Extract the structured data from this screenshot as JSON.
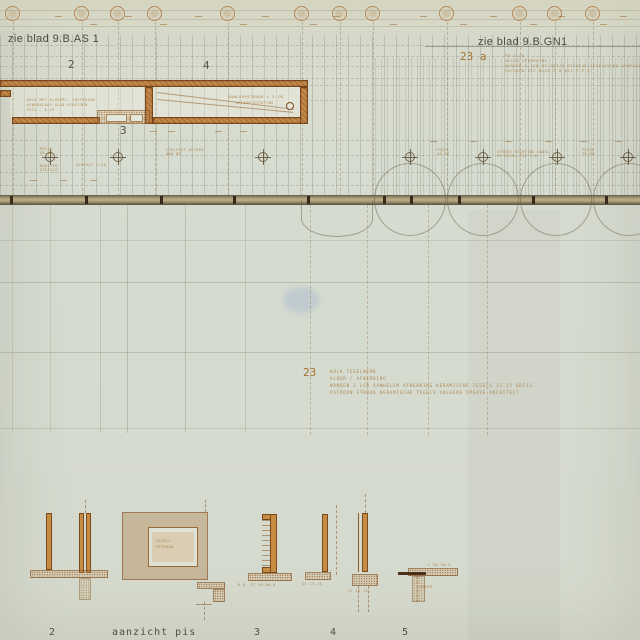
{
  "sheet": {
    "match_left": "zie blad 9.B.AS 1",
    "match_right": "zie blad 9.B.GN1"
  },
  "plan": {
    "grid_label_2": "2",
    "grid_label_4": "4",
    "detail_label_3": "3"
  },
  "notes": {
    "a": {
      "num": "23 a",
      "lines": [
        "PB GLAD",
        "KOLOM AFWERKING",
        "WANDEN  2 LGN KZ GRIJS  GEVOEGD OPGELEVERD  AFWERKING NADER",
        "PATROON  ZIE BLAD 9.B  N13  T.P.V."
      ]
    },
    "b": {
      "num": "23",
      "lines": [
        "KOLK TEGELWERK",
        "VLOER / AFWERKING",
        "WANDEN  2 LGN  AANHELEN  AFWERKING KERAMISCHE  TEGELS  15.15  GRIJS",
        "PATROON  STROOK KERAMISCHE TEGELS  VOLGENS  OPGAVE  ARCHITECT"
      ]
    }
  },
  "bottom_labels": [
    {
      "t": "2",
      "x": 49
    },
    {
      "t": "aanzicht pis",
      "x": 112
    },
    {
      "t": "3",
      "x": 254
    },
    {
      "t": "4",
      "x": 330
    },
    {
      "t": "5",
      "x": 402
    }
  ],
  "drawing": {
    "bubble_xs": [
      13,
      82,
      118,
      155,
      228,
      302,
      340,
      373,
      447,
      520,
      555,
      593
    ],
    "band_tick_xs": [
      10,
      85,
      160,
      233,
      307,
      383,
      410,
      458,
      532,
      605
    ],
    "cross_xs": [
      50,
      118,
      263,
      410,
      483,
      557,
      628
    ],
    "circle_xs": [
      410,
      483,
      556,
      629
    ],
    "half_circle_x": 337,
    "mid_vert": [
      {
        "x": 12,
        "o": 0.2
      },
      {
        "x": 50,
        "o": 0.2
      },
      {
        "x": 100,
        "o": 0.25
      },
      {
        "x": 127,
        "o": 0.3
      },
      {
        "x": 185,
        "o": 0.3
      },
      {
        "x": 245,
        "o": 0.22
      }
    ],
    "mid_dash_xs": [
      310,
      367,
      428,
      487
    ],
    "mid_horiz": [
      {
        "y": 240,
        "o": 0.2
      },
      {
        "y": 282,
        "o": 0.3
      },
      {
        "y": 352,
        "o": 0.3
      },
      {
        "y": 428,
        "o": 0.22
      }
    ],
    "band_hdots": [
      {
        "y": 45,
        "x": 0,
        "w": 640
      },
      {
        "y": 56,
        "x": 0,
        "w": 640
      },
      {
        "y": 66,
        "x": 0,
        "w": 640
      },
      {
        "y": 78,
        "x": 0,
        "w": 640
      },
      {
        "y": 85,
        "x": 310,
        "w": 330
      },
      {
        "y": 100,
        "x": 310,
        "w": 330
      },
      {
        "y": 140,
        "x": 0,
        "w": 640
      },
      {
        "y": 155,
        "x": 0,
        "w": 640
      },
      {
        "y": 172,
        "x": 0,
        "w": 640
      },
      {
        "y": 185,
        "x": 0,
        "w": 640
      }
    ],
    "dim_marks": [
      {
        "x": 55,
        "y": 16
      },
      {
        "x": 125,
        "y": 16
      },
      {
        "x": 195,
        "y": 16
      },
      {
        "x": 262,
        "y": 16
      },
      {
        "x": 333,
        "y": 16
      },
      {
        "x": 420,
        "y": 16
      },
      {
        "x": 490,
        "y": 16
      },
      {
        "x": 558,
        "y": 16
      },
      {
        "x": 620,
        "y": 16
      },
      {
        "x": 90,
        "y": 24
      },
      {
        "x": 160,
        "y": 24
      },
      {
        "x": 240,
        "y": 24
      },
      {
        "x": 310,
        "y": 24
      },
      {
        "x": 390,
        "y": 24
      },
      {
        "x": 460,
        "y": 24
      },
      {
        "x": 530,
        "y": 24
      },
      {
        "x": 600,
        "y": 24
      },
      {
        "x": 150,
        "y": 131
      },
      {
        "x": 168,
        "y": 131
      },
      {
        "x": 215,
        "y": 131
      },
      {
        "x": 240,
        "y": 131
      },
      {
        "x": 430,
        "y": 141
      },
      {
        "x": 470,
        "y": 141
      },
      {
        "x": 505,
        "y": 141
      },
      {
        "x": 545,
        "y": 141
      },
      {
        "x": 580,
        "y": 141
      },
      {
        "x": 615,
        "y": 141
      },
      {
        "x": 30,
        "y": 180
      },
      {
        "x": 60,
        "y": 180
      },
      {
        "x": 90,
        "y": 180
      }
    ],
    "dash_vlines": [
      {
        "x": 85,
        "y": 500,
        "h": 13
      },
      {
        "x": 205,
        "y": 500,
        "h": 12
      },
      {
        "x": 204,
        "y": 602,
        "h": 18
      },
      {
        "x": 336,
        "y": 505,
        "h": 70
      },
      {
        "x": 358,
        "y": 586,
        "h": 26
      },
      {
        "x": 368,
        "y": 586,
        "h": 26
      },
      {
        "x": 365,
        "y": 494,
        "h": 19
      },
      {
        "x": 417,
        "y": 576,
        "h": 26
      }
    ],
    "annotations": [
      {
        "x": 27,
        "y": 98,
        "t": "KOLK MET VLOERPL. INSTORTEN",
        "fs": 3.2
      },
      {
        "x": 27,
        "y": 103,
        "t": "AFWERKLAAG GLAD AFREIJEN",
        "fs": 3.2
      },
      {
        "x": 27,
        "y": 108,
        "t": "PEIL - 0.45",
        "fs": 3.2
      },
      {
        "x": 228,
        "y": 95,
        "t": "AANLOOPSTROOK ± 3 CM",
        "fs": 3.6
      },
      {
        "x": 236,
        "y": 101,
        "t": "AFLOOP RICHTING",
        "fs": 3.2
      },
      {
        "x": 40,
        "y": 147,
        "t": "PUTJE",
        "fs": 3.2
      },
      {
        "x": 40,
        "y": 151,
        "t": "30.30",
        "fs": 3.2
      },
      {
        "x": 40,
        "y": 164,
        "t": "ROOSTER",
        "fs": 3.2
      },
      {
        "x": 40,
        "y": 168,
        "t": "GIETIJZ.",
        "fs": 3.2
      },
      {
        "x": 76,
        "y": 163,
        "t": "AFSCHOT 1:50",
        "fs": 3.2
      },
      {
        "x": 166,
        "y": 148,
        "t": "STELPOST AFVOER",
        "fs": 3.2
      },
      {
        "x": 166,
        "y": 152,
        "t": "HWA 80",
        "fs": 3.2
      },
      {
        "x": 437,
        "y": 148,
        "t": "PUTJE",
        "fs": 3.2
      },
      {
        "x": 437,
        "y": 152,
        "t": "30.30",
        "fs": 3.2
      },
      {
        "x": 497,
        "y": 150,
        "t": "AFVOER RICHTING AANSL.",
        "fs": 3.2
      },
      {
        "x": 497,
        "y": 154,
        "t": "OP RIOOL ZIE 9.B",
        "fs": 3.2
      },
      {
        "x": 582,
        "y": 148,
        "t": "PUTJE",
        "fs": 3.2
      },
      {
        "x": 582,
        "y": 152,
        "t": "30.30",
        "fs": 3.2
      },
      {
        "x": 156,
        "y": 539,
        "t": "TEGELS",
        "fs": 3.2
      },
      {
        "x": 156,
        "y": 545,
        "t": "PATROON",
        "fs": 3.2
      },
      {
        "x": 238,
        "y": 583,
        "t": "B.B. ST 10.60.8",
        "fs": 3.2
      },
      {
        "x": 302,
        "y": 582,
        "t": "ST 15.15",
        "fs": 3.2
      },
      {
        "x": 348,
        "y": 589,
        "t": "ST 15.15",
        "fs": 3.2
      },
      {
        "x": 428,
        "y": 563,
        "t": "L 50.50.5",
        "fs": 3.2
      },
      {
        "x": 420,
        "y": 585,
        "t": "ANKER",
        "fs": 3.2
      }
    ]
  },
  "colors": {
    "ink_orange": "#a3702f",
    "ink_gray": "#4b4b42",
    "wall_fill": "#c4874a",
    "wall_edge": "#7c4a1d",
    "band_tan": "#b0a47e",
    "paper": "#d7dbce"
  }
}
